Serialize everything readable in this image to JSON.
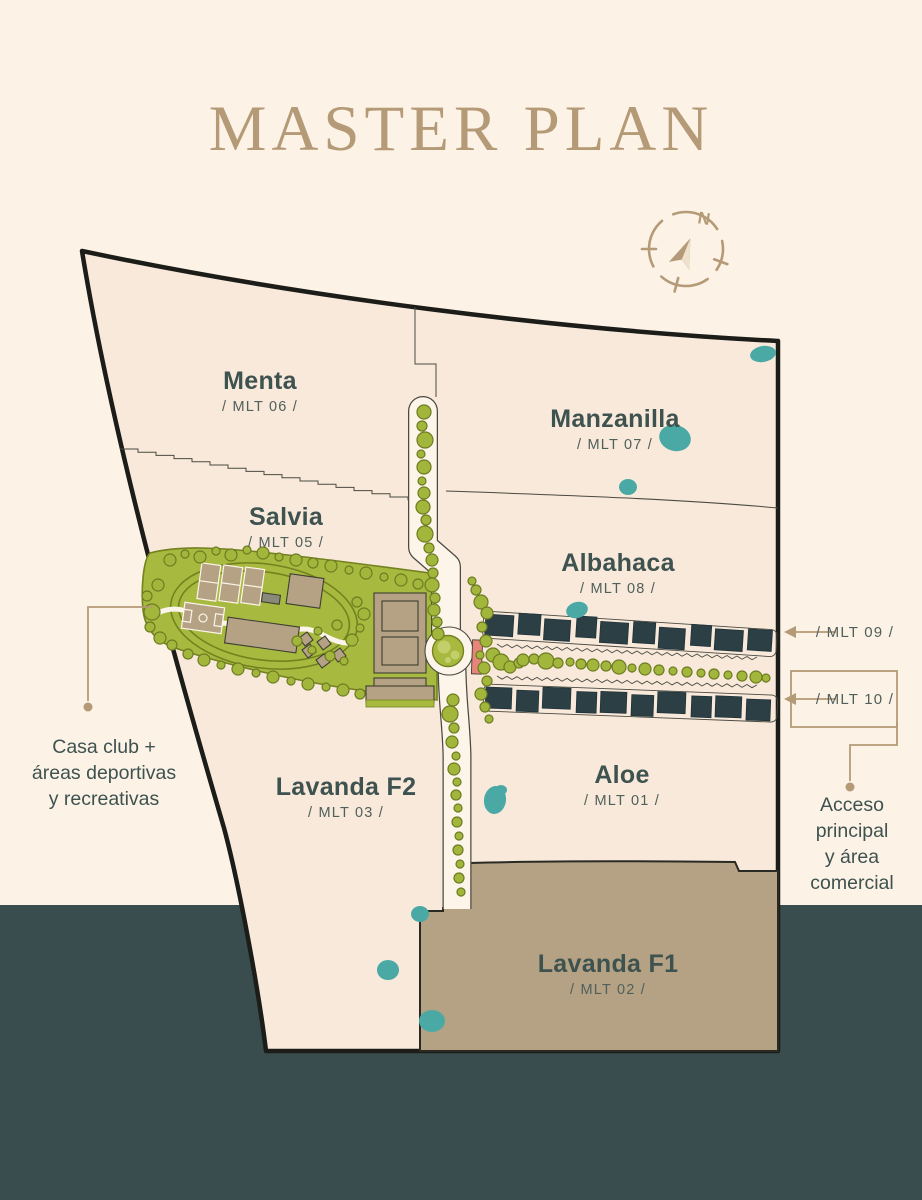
{
  "title": "MASTER PLAN",
  "compass": {
    "north_label": "N"
  },
  "zones": [
    {
      "id": "menta",
      "name": "Menta",
      "code": "/ MLT 06 /"
    },
    {
      "id": "manzanilla",
      "name": "Manzanilla",
      "code": "/ MLT 07 /"
    },
    {
      "id": "salvia",
      "name": "Salvia",
      "code": "/ MLT 05 /"
    },
    {
      "id": "albahaca",
      "name": "Albahaca",
      "code": "/ MLT 08 /"
    },
    {
      "id": "lavanda-f2",
      "name": "Lavanda F2",
      "code": "/ MLT 03 /"
    },
    {
      "id": "aloe",
      "name": "Aloe",
      "code": "/ MLT 01 /"
    },
    {
      "id": "lavanda-f1",
      "name": "Lavanda F1",
      "code": "/ MLT 02 /"
    }
  ],
  "callouts": {
    "mlt09": "/ MLT 09 /",
    "mlt10": "/ MLT 10 /",
    "casa_club": {
      "line1": "Casa club +",
      "line2": "áreas deportivas",
      "line3": "y recreativas"
    },
    "acceso": {
      "line1": "Acceso",
      "line2": "principal",
      "line3": "y área",
      "line4": "comercial"
    }
  },
  "colors": {
    "background": "#fcf2e6",
    "footer_band": "#394d4e",
    "map_fill": "#f8e9db",
    "map_outline": "#1c1c19",
    "line_thin": "#4a4a40",
    "accent_tan": "#b49a76",
    "label_text": "#3e5250",
    "code_text": "#50605b",
    "green_fill": "#a7ba3f",
    "green_outline": "#73821f",
    "green_light": "#c3cf6a",
    "tree_fill": "#a3b63c",
    "tree_stroke": "#6d7c21",
    "water_teal": "#4aa9a4",
    "building_tan": "#b5a284",
    "building_stroke": "#3e3e32",
    "house_block": "#2c3f45",
    "road_fill": "#fdf5ea",
    "entrance_pink": "#e8857b"
  }
}
